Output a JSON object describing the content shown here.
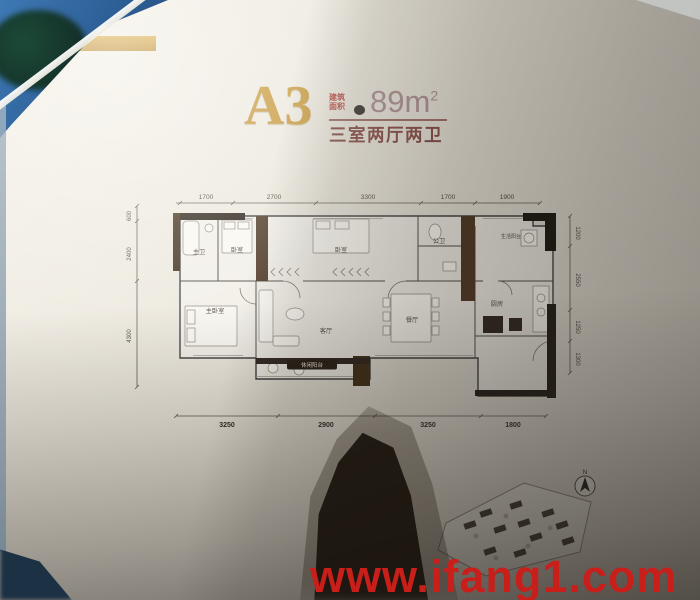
{
  "photo": {
    "watermark": "www.ifang1.com"
  },
  "title": {
    "plan_code": "A3",
    "area_label_line1": "建筑",
    "area_label_line2": "面积",
    "area_value": "89m",
    "area_sup": "2",
    "subtitle": "三室两厅两卫"
  },
  "plan": {
    "dims_top": [
      "1700",
      "2700",
      "3300",
      "1700",
      "1900"
    ],
    "dims_bottom": [
      "3250",
      "2900",
      "3250",
      "1800"
    ],
    "dims_left": [
      "600",
      "2400",
      "4300"
    ],
    "dims_right": [
      "1200",
      "2550",
      "1250",
      "1300"
    ],
    "rooms": {
      "master_bath": "主卫",
      "bedroom_a": "卧室",
      "bedroom_b": "卧室",
      "second_bath": "公卫",
      "utility_balcony": "生活阳台",
      "master_bedroom": "主卧室",
      "living": "客厅",
      "dining": "餐厅",
      "kitchen": "厨房",
      "leisure_balcony": "休闲阳台"
    }
  },
  "site_plan": {
    "north_label": "N"
  },
  "colors": {
    "gold": "#c3922e",
    "title_maroon": "#7c3f38",
    "area_mauve": "#a5888a",
    "watermark_red": "#c81f1a"
  }
}
